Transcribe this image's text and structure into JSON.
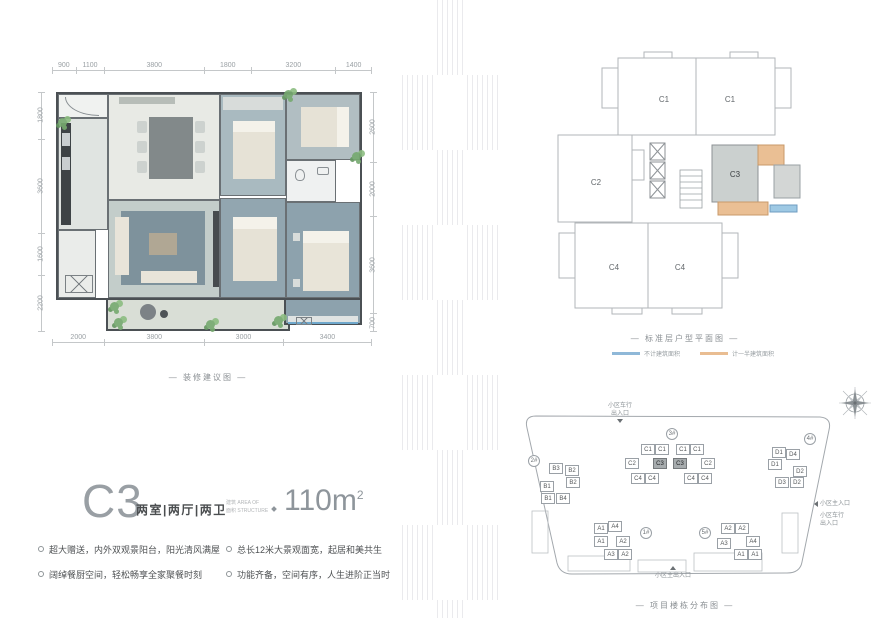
{
  "floorplan": {
    "caption": "— 装修建议图 —",
    "dims_top": [
      "900",
      "1100",
      "3800",
      "1800",
      "3200",
      "1400"
    ],
    "dims_bottom": [
      "2000",
      "3800",
      "3000",
      "3400"
    ],
    "dims_left": [
      "1800",
      "3600",
      "1600",
      "2200"
    ],
    "dims_right": [
      "2600",
      "2000",
      "3600",
      "700"
    ]
  },
  "unit": {
    "code": "C3",
    "rooms": "两室|两厅|两卫",
    "area_label_line1": "建筑 AREA OF",
    "area_label_line2": "面积 STRUCTURE",
    "area_value": "110m",
    "area_sup": "2",
    "bullets_col1": [
      "超大赠送，内外双观景阳台，阳光清风满屋",
      "阔绰餐厨空间，轻松畅享全家聚餐时刻"
    ],
    "bullets_col2": [
      "总长12米大景观面宽，起居和美共生",
      "功能齐备，空间有序，人生进阶正当时"
    ]
  },
  "standard_floor": {
    "caption": "— 标准层户型平面图 —",
    "units": {
      "c1a": "C1",
      "c1b": "C1",
      "c2": "C2",
      "c3": "C3",
      "c4a": "C4",
      "c4b": "C4"
    },
    "legend": [
      {
        "label": "不计建筑面积",
        "color": "#8fb8d8"
      },
      {
        "label": "计一半建筑面积",
        "color": "#e9bd92"
      }
    ]
  },
  "site_plan": {
    "caption": "— 项目楼栋分布图 —",
    "buildings": {
      "b1": "1#",
      "b2": "2#",
      "b3": "3#",
      "b4": "4#",
      "b5": "5#"
    },
    "entrances": {
      "top_line1": "小区车行",
      "top_line2": "出入口",
      "right_main": "小区主入口",
      "right_line1": "小区车行",
      "right_line2": "出入口",
      "bottom": "小区主出入口"
    },
    "clusters": {
      "b3": {
        "row1": [
          "C1",
          "C1",
          "C1",
          "C1"
        ],
        "row2": [
          "C2",
          "C3",
          "C3",
          "C2"
        ],
        "row3": [
          "C4",
          "C4",
          "C4",
          "C4"
        ]
      },
      "b2": {
        "cells": [
          "B3",
          "B2",
          "B2",
          "B1",
          "B1",
          "B4"
        ]
      },
      "b4": {
        "cells": [
          "D1",
          "D4",
          "D1",
          "D2",
          "D3",
          "D2"
        ]
      },
      "b1": {
        "cells": [
          "A1",
          "A4",
          "A1",
          "A2",
          "A3",
          "A2"
        ]
      },
      "b5": {
        "cells": [
          "A2",
          "A2",
          "A3",
          "A4",
          "A1",
          "A1"
        ]
      }
    },
    "highlight_color": "#a7acae"
  }
}
